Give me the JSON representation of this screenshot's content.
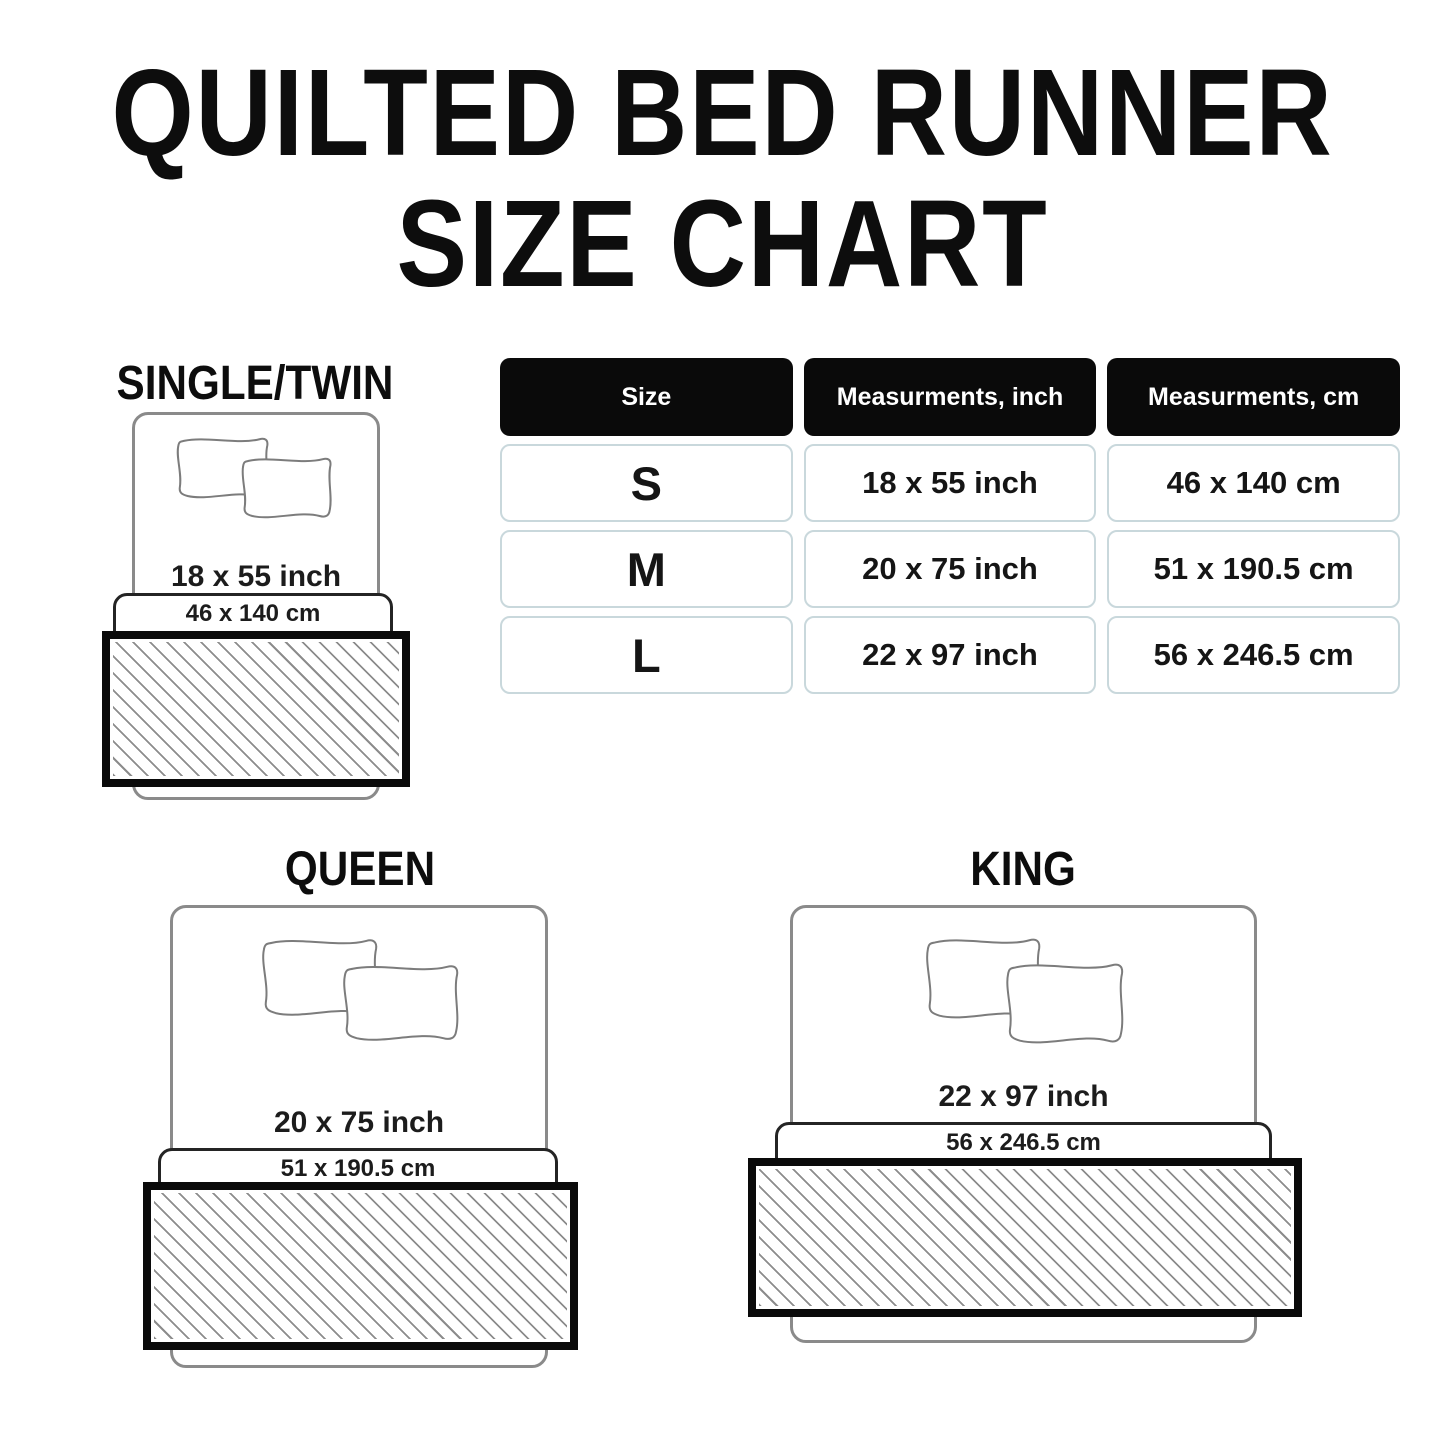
{
  "title": {
    "line1": "QUILTED BED RUNNER",
    "line2": "SIZE CHART"
  },
  "table": {
    "headers": [
      "Size",
      "Measurments, inch",
      "Measurments, cm"
    ],
    "rows": [
      {
        "size": "S",
        "inch": "18 x 55 inch",
        "cm": "46 x 140 cm"
      },
      {
        "size": "M",
        "inch": "20 x 75 inch",
        "cm": "51 x 190.5 cm"
      },
      {
        "size": "L",
        "inch": "22 x 97 inch",
        "cm": "56 x 246.5 cm"
      }
    ]
  },
  "diagrams": [
    {
      "label": "SINGLE/TWIN",
      "inch": "18 x 55 inch",
      "cm": "46 x 140 cm"
    },
    {
      "label": "QUEEN",
      "inch": "20 x 75 inch",
      "cm": "51 x 190.5 cm"
    },
    {
      "label": "KING",
      "inch": "22 x 97 inch",
      "cm": "56 x 246.5 cm"
    }
  ],
  "colors": {
    "header_bg": "#0a0a0a",
    "header_text": "#ffffff",
    "cell_border": "#c9d8dc",
    "bed_outline": "#8a8a8a",
    "band_outline": "#242424",
    "runner_border": "#0a0a0a",
    "hatch_line": "#8c8c8c",
    "text": "#111111"
  }
}
